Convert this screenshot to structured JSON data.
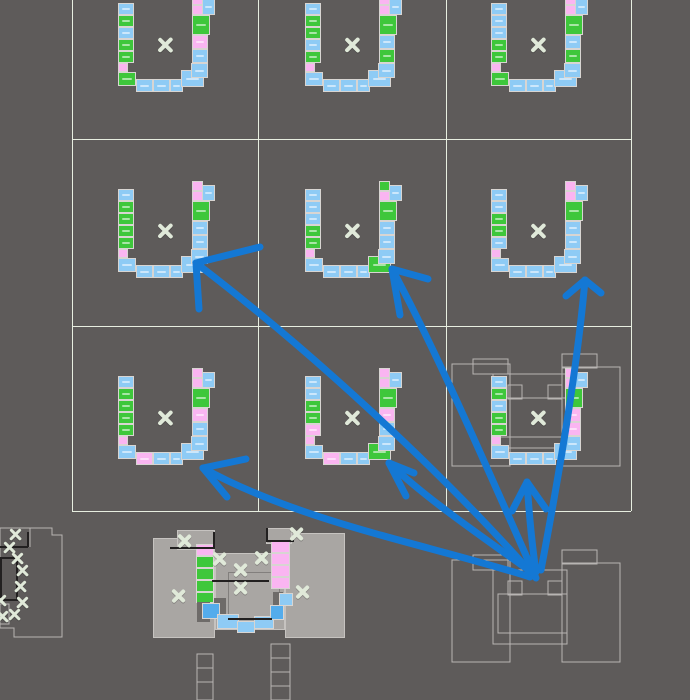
{
  "canvas": {
    "width": 690,
    "height": 700,
    "background": "#5E5B5A"
  },
  "palette": {
    "blue": "#8ECBF5",
    "blue_deep": "#54ACEC",
    "green": "#3EC73B",
    "pink": "#FAB5F1",
    "grid_line": "#E7EEE0",
    "wire": "#B8B5B3",
    "arrow": "#1478D4",
    "cross": "#E0E9D9",
    "body": "#A9A6A3",
    "body_edge": "#C6C3C0",
    "dark": "#6E6B69",
    "black": "#222020",
    "tile_border": "#D8D5D2",
    "inner_edge": "#827F7D"
  },
  "grid": {
    "vertical": [
      72,
      258,
      446,
      631
    ],
    "horizontal": [
      139,
      326,
      511
    ],
    "left": 72,
    "right": 631,
    "top": 0,
    "bottom": 511
  },
  "module_slots": [
    {
      "x": -47,
      "y": -42,
      "w": 16,
      "h": 12
    },
    {
      "x": -47,
      "y": -30,
      "w": 16,
      "h": 12
    },
    {
      "x": -47,
      "y": -18,
      "w": 16,
      "h": 12
    },
    {
      "x": -47,
      "y": -6,
      "w": 16,
      "h": 12
    },
    {
      "x": -47,
      "y": 6,
      "w": 16,
      "h": 12
    },
    {
      "x": -47,
      "y": 18,
      "w": 10,
      "h": 9
    },
    {
      "x": -47,
      "y": 27,
      "w": 18,
      "h": 14
    },
    {
      "x": -29,
      "y": 34,
      "w": 17,
      "h": 13
    },
    {
      "x": -12,
      "y": 34,
      "w": 17,
      "h": 13
    },
    {
      "x": 5,
      "y": 34,
      "w": 13,
      "h": 13
    },
    {
      "x": 16,
      "y": 25,
      "w": 23,
      "h": 17
    },
    {
      "x": 26,
      "y": 18,
      "w": 17,
      "h": 15
    },
    {
      "x": 27,
      "y": 4,
      "w": 16,
      "h": 14
    },
    {
      "x": 27,
      "y": -10,
      "w": 16,
      "h": 14
    },
    {
      "x": 27,
      "y": -30,
      "w": 18,
      "h": 20
    },
    {
      "x": 27,
      "y": -40,
      "w": 11,
      "h": 10
    },
    {
      "x": 37,
      "y": -46,
      "w": 13,
      "h": 16
    },
    {
      "x": 27,
      "y": -50,
      "w": 11,
      "h": 10
    }
  ],
  "modules": [
    {
      "name": "r1c1",
      "cx": 165,
      "cy": 45,
      "colors": [
        "b",
        "g",
        "b",
        "g",
        "g",
        "p",
        "g",
        "b",
        "b",
        "b",
        "b",
        "b",
        "b",
        "p",
        "g",
        "p",
        "b",
        "p"
      ]
    },
    {
      "name": "r1c2",
      "cx": 352,
      "cy": 45,
      "colors": [
        "b",
        "g",
        "g",
        "b",
        "g",
        "p",
        "b",
        "b",
        "b",
        "b",
        "b",
        "b",
        "g",
        "b",
        "g",
        "p",
        "b",
        "p"
      ]
    },
    {
      "name": "r1c3",
      "cx": 538,
      "cy": 45,
      "colors": [
        "b",
        "b",
        "b",
        "g",
        "g",
        "p",
        "g",
        "b",
        "b",
        "b",
        "b",
        "b",
        "g",
        "b",
        "g",
        "p",
        "b",
        "p"
      ]
    },
    {
      "name": "r2c1",
      "cx": 165,
      "cy": 231,
      "colors": [
        "b",
        "g",
        "g",
        "g",
        "g",
        "p",
        "b",
        "b",
        "b",
        "b",
        "b",
        "b",
        "b",
        "b",
        "g",
        "p",
        "b",
        "p"
      ]
    },
    {
      "name": "r2c2",
      "cx": 352,
      "cy": 231,
      "colors": [
        "b",
        "b",
        "b",
        "g",
        "g",
        "p",
        "b",
        "b",
        "b",
        "b",
        "g",
        "b",
        "b",
        "b",
        "g",
        "p",
        "b",
        "g"
      ]
    },
    {
      "name": "r2c3",
      "cx": 538,
      "cy": 231,
      "colors": [
        "b",
        "b",
        "g",
        "g",
        "b",
        "p",
        "b",
        "b",
        "b",
        "b",
        "b",
        "b",
        "b",
        "b",
        "g",
        "p",
        "b",
        "p"
      ]
    },
    {
      "name": "r3c1",
      "cx": 165,
      "cy": 418,
      "colors": [
        "b",
        "g",
        "g",
        "g",
        "g",
        "p",
        "b",
        "p",
        "b",
        "b",
        "b",
        "b",
        "b",
        "p",
        "g",
        "p",
        "b",
        "p"
      ]
    },
    {
      "name": "r3c2",
      "cx": 352,
      "cy": 418,
      "colors": [
        "b",
        "b",
        "g",
        "g",
        "p",
        "p",
        "b",
        "p",
        "b",
        "b",
        "g",
        "b",
        "b",
        "p",
        "g",
        "p",
        "b",
        "p"
      ]
    },
    {
      "name": "r3c3",
      "cx": 538,
      "cy": 418,
      "colors": [
        "b",
        "g",
        "b",
        "g",
        "g",
        "p",
        "b",
        "b",
        "b",
        "b",
        "b",
        "b",
        "p",
        "p",
        "g",
        "p",
        "b",
        "p"
      ]
    }
  ],
  "ghost_building": {
    "rects": [
      [
        452,
        364,
        58,
        102
      ],
      [
        473,
        359,
        35,
        15
      ],
      [
        562,
        354,
        35,
        14
      ],
      [
        562,
        367,
        58,
        99
      ],
      [
        493,
        374,
        74,
        74
      ],
      [
        508,
        385,
        14,
        14
      ],
      [
        548,
        385,
        14,
        14
      ],
      [
        498,
        398,
        69,
        39
      ]
    ]
  },
  "source_building": {
    "rects": [
      [
        452,
        560,
        58,
        102
      ],
      [
        473,
        555,
        35,
        15
      ],
      [
        562,
        550,
        35,
        14
      ],
      [
        562,
        563,
        58,
        99
      ],
      [
        493,
        570,
        74,
        74
      ],
      [
        508,
        581,
        14,
        14
      ],
      [
        548,
        581,
        14,
        14
      ],
      [
        498,
        594,
        69,
        39
      ]
    ]
  },
  "ladders": [
    {
      "x": 197,
      "y": 654,
      "w": 16,
      "h": 46,
      "rungs": [
        668,
        682
      ]
    },
    {
      "x": 271,
      "y": 644,
      "w": 19,
      "h": 56,
      "rungs": [
        658,
        672,
        686
      ]
    }
  ],
  "left_building": {
    "outline": "M0,528 L52,528 L52,535 L62,535 L62,637 L14,637 L14,628 L0,628 Z",
    "inner": "M30,528 L30,547",
    "stub": "M0,604 L9,604 L9,624 L0,624",
    "blacks": [
      [
        0,
        546,
        28,
        2
      ],
      [
        27,
        532,
        2,
        15
      ]
    ],
    "black_outline": [
      1,
      558,
      16,
      42
    ]
  },
  "center_building": {
    "rects": [
      [
        153,
        538,
        62,
        100,
        "body"
      ],
      [
        285,
        533,
        60,
        105,
        "body"
      ],
      [
        215,
        553,
        70,
        77,
        "body"
      ],
      [
        177,
        530,
        38,
        20,
        "body"
      ],
      [
        266,
        528,
        26,
        16,
        "body"
      ],
      [
        228,
        572,
        52,
        48,
        "inner"
      ],
      [
        196,
        544,
        18,
        12,
        "pink"
      ],
      [
        196,
        556,
        18,
        12,
        "green"
      ],
      [
        196,
        568,
        18,
        12,
        "green"
      ],
      [
        196,
        580,
        18,
        12,
        "green"
      ],
      [
        196,
        592,
        18,
        11,
        "green"
      ],
      [
        271,
        541,
        19,
        12,
        "pink"
      ],
      [
        271,
        553,
        19,
        12,
        "pink"
      ],
      [
        271,
        565,
        19,
        12,
        "pink"
      ],
      [
        271,
        577,
        19,
        12,
        "pink"
      ],
      [
        214,
        598,
        12,
        16,
        "dark"
      ],
      [
        197,
        602,
        13,
        20,
        "dark"
      ],
      [
        273,
        592,
        10,
        16,
        "dark"
      ],
      [
        202,
        603,
        18,
        16,
        "deep"
      ],
      [
        217,
        614,
        22,
        15,
        "blue"
      ],
      [
        237,
        621,
        18,
        12,
        "blue"
      ],
      [
        254,
        616,
        20,
        13,
        "blue"
      ],
      [
        270,
        605,
        14,
        15,
        "deep"
      ],
      [
        279,
        593,
        14,
        13,
        "blue"
      ],
      [
        170,
        547,
        45,
        2,
        "black"
      ],
      [
        213,
        532,
        2,
        16,
        "black"
      ],
      [
        266,
        528,
        2,
        14,
        "black"
      ],
      [
        268,
        540,
        26,
        2,
        "black"
      ],
      [
        212,
        580,
        57,
        2,
        "black"
      ],
      [
        228,
        618,
        44,
        2,
        "black"
      ]
    ]
  },
  "markers": [
    {
      "x": 165,
      "y": 45,
      "s": 16
    },
    {
      "x": 352,
      "y": 45,
      "s": 16
    },
    {
      "x": 538,
      "y": 45,
      "s": 16
    },
    {
      "x": 165,
      "y": 231,
      "s": 16
    },
    {
      "x": 352,
      "y": 231,
      "s": 16
    },
    {
      "x": 538,
      "y": 231,
      "s": 16
    },
    {
      "x": 165,
      "y": 418,
      "s": 16
    },
    {
      "x": 352,
      "y": 418,
      "s": 16
    },
    {
      "x": 538,
      "y": 418,
      "s": 16
    },
    {
      "x": 185,
      "y": 541,
      "s": 15
    },
    {
      "x": 220,
      "y": 559,
      "s": 15
    },
    {
      "x": 241,
      "y": 570,
      "s": 15
    },
    {
      "x": 262,
      "y": 558,
      "s": 15
    },
    {
      "x": 297,
      "y": 534,
      "s": 15
    },
    {
      "x": 241,
      "y": 588,
      "s": 15
    },
    {
      "x": 179,
      "y": 596,
      "s": 15
    },
    {
      "x": 303,
      "y": 592,
      "s": 15
    },
    {
      "x": 16,
      "y": 535,
      "s": 13
    },
    {
      "x": 10,
      "y": 548,
      "s": 13
    },
    {
      "x": 18,
      "y": 559,
      "s": 13
    },
    {
      "x": 23,
      "y": 571,
      "s": 13
    },
    {
      "x": 21,
      "y": 587,
      "s": 13
    },
    {
      "x": 23,
      "y": 603,
      "s": 13
    },
    {
      "x": 15,
      "y": 615,
      "s": 13
    },
    {
      "x": 3,
      "y": 617,
      "s": 13
    },
    {
      "x": 1,
      "y": 601,
      "s": 13
    }
  ],
  "arrows": {
    "width": 7,
    "items": [
      {
        "path": "M533,575 C440,470 310,350 196,263",
        "barbs": [
          [
            196,
            263,
            260,
            247
          ],
          [
            196,
            263,
            199,
            309
          ]
        ]
      },
      {
        "path": "M536,578 C488,470 436,350 392,269",
        "barbs": [
          [
            392,
            269,
            428,
            279
          ],
          [
            392,
            269,
            400,
            315
          ]
        ]
      },
      {
        "path": "M541,570 C560,470 578,360 585,280",
        "barbs": [
          [
            585,
            280,
            566,
            296
          ],
          [
            585,
            280,
            601,
            293
          ]
        ]
      },
      {
        "path": "M530,577 C430,545 300,522 203,468",
        "barbs": [
          [
            203,
            468,
            246,
            459
          ],
          [
            203,
            468,
            227,
            497
          ]
        ]
      },
      {
        "path": "M534,574 C480,535 428,500 389,463",
        "barbs": [
          [
            389,
            463,
            414,
            473
          ],
          [
            389,
            463,
            406,
            496
          ]
        ]
      },
      {
        "path": "M536,572 C532,545 529,512 527,482",
        "barbs": [
          [
            527,
            482,
            512,
            511
          ],
          [
            527,
            482,
            546,
            509
          ]
        ]
      }
    ]
  }
}
